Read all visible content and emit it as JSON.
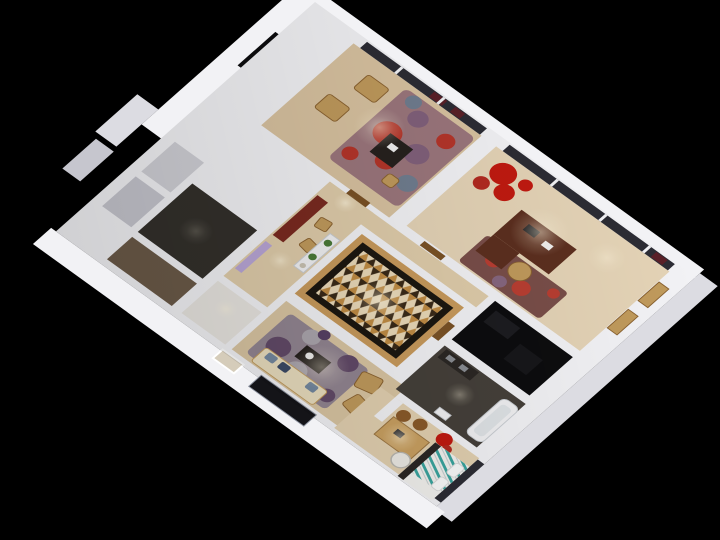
{
  "scene": {
    "description": "3D isometric dollhouse cutaway render of an apartment floor plan, viewed from above, rotated diagonally on a pure black background with warm interior lighting",
    "background_color": "#000000",
    "view": "top-down axonometric, plan rotated roughly 36 degrees",
    "no_visible_text": true
  },
  "palette": {
    "bg": "#000000",
    "wall": "#f2f2f5",
    "wallShade": "#dcdce2",
    "wallDark": "#c6c6ce",
    "glass": "#2c2c34",
    "darkRecess": "#0b0b0d",
    "woodStudy": "#d8c2a0",
    "woodOffice": "#e4d3b6",
    "woodHall": "#dfccaa",
    "woodLiving": "#d9c5a2",
    "woodBed": "#e2d0b0",
    "rugStudyBase": "#96707a",
    "rugRed": "#b22a20",
    "flowerRed": "#c01a10",
    "rugPurple": "#7a5878",
    "rugBlue": "#68788e",
    "rugOfficeBase": "#6b3c3a",
    "rugLivingBase": "#8d8090",
    "rugLivingPurple": "#584064",
    "rugLivingGray": "#a8a4ae",
    "sofaCream": "#e9ddbe",
    "pillowBlue": "#74889f",
    "pillowNavy": "#3c4a66",
    "chairTan": "#c09a5c",
    "stoolBrown": "#8a5a2a",
    "deskWalnut": "#5c2f1f",
    "consoleMaroon": "#7a2a20",
    "tableDark": "#26211e",
    "patternBorderWood": "#c89a5c",
    "patternBlack": "#1c1710",
    "patternBase": "#ead9b8",
    "patternTan": "#c08c44",
    "patternDark": "#3a2a18",
    "floorGray": "#d0d0d6",
    "floorDark1": "#33302b",
    "floorDark2": "#6b5a48",
    "entryFloor": "#e8e5e0",
    "bathFloor": "#45403a",
    "closetFloor": "#0d0d0f",
    "tealStripe": "#3aa49e",
    "bedWhite": "#f2f1ee",
    "deskWood": "#c9a061",
    "chairWhite": "#eceae4",
    "lavender": "#b9a6d6",
    "plantGreen": "#4a7a38",
    "tvBlack": "#141418",
    "curtainMaroon": "#5a2028",
    "doorWood": "#7a5226",
    "lightGlow": "#fff7e0"
  },
  "rooms": [
    {
      "id": "study-lounge",
      "contents": [
        "red-purple floral rug",
        "two tan armchairs",
        "dark tea table",
        "gold stool",
        "window wall with maroon curtains"
      ]
    },
    {
      "id": "office",
      "contents": [
        "walnut L-desk",
        "wicker chair",
        "dark red rug",
        "large red flower arrangement",
        "window seat with tan cushions",
        "floor-to-ceiling windows"
      ]
    },
    {
      "id": "pattern-room",
      "contents": [
        "geometric tan-cream-brown patterned floor",
        "black border band",
        "wood surround"
      ]
    },
    {
      "id": "hallway",
      "contents": [
        "maroon console",
        "two wooden chairs",
        "lavender glass cabinet",
        "console table with plants"
      ]
    },
    {
      "id": "utility-block",
      "contents": [
        "dark-floored bathroom",
        "brown-floored storage",
        "small gray-floored rooms"
      ]
    },
    {
      "id": "living-room",
      "contents": [
        "cream sofa with blue pillows",
        "purple-gray rug",
        "dark coffee table",
        "two tan armchairs",
        "wall TV panel",
        "framed picture"
      ]
    },
    {
      "id": "bedroom",
      "contents": [
        "bed with teal striped bedding",
        "wooden desk",
        "two brown stools",
        "white barrel chair",
        "red flowers",
        "dark window"
      ]
    },
    {
      "id": "bathroom",
      "contents": [
        "white tub",
        "dark vanity counter"
      ]
    },
    {
      "id": "closet",
      "contents": [
        "unlit dark floor"
      ]
    }
  ]
}
